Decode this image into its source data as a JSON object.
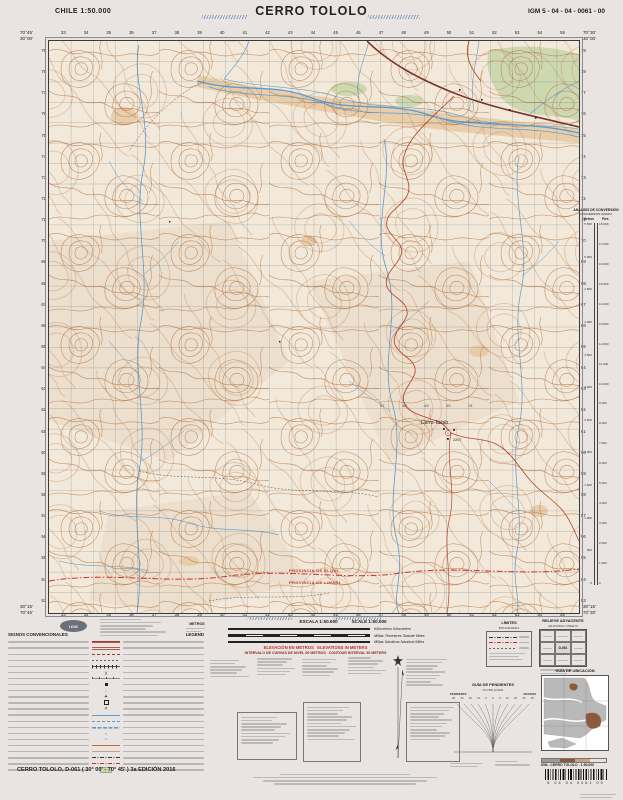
{
  "sheet": {
    "country_scale": "CHILE  1:50.000",
    "title": "CERRO TOLOLO",
    "code": "IGM 5 - 04 - 04 - 0061 - 00",
    "footer_line": "CERRO TOLOLO, D-061 ( 30° 00' - 70° 45' ) 3a EDICIÓN 2016",
    "igm_product_line": "IGM - CERRO TOLOLO - 1:50.000",
    "barcode_digits": "5  04  04  0061  00",
    "logo": "IGM"
  },
  "map": {
    "corners": {
      "top_left_lon": "70°45'",
      "top_right_lon": "70°30'",
      "top_lat": "30°00'",
      "bottom_lat": "30°15'",
      "bottom_left_lon": "70°45'",
      "bottom_right_lon": "70°30'"
    },
    "grid_eastings": [
      "33",
      "34",
      "35",
      "36",
      "37",
      "38",
      "39",
      "40",
      "41",
      "42",
      "43",
      "44",
      "45",
      "46",
      "47",
      "48",
      "49",
      "50",
      "51",
      "52",
      "53",
      "54",
      "55"
    ],
    "grid_northings": [
      "79",
      "78",
      "77",
      "76",
      "75",
      "74",
      "73",
      "72",
      "71",
      "70",
      "69",
      "68",
      "67",
      "66",
      "65",
      "64",
      "63",
      "62",
      "61",
      "60",
      "59",
      "58",
      "57",
      "56",
      "55",
      "54",
      "53"
    ],
    "interior_eastings": [
      "47",
      "48",
      "49",
      "50",
      "51"
    ],
    "labels": {
      "peak": "Cerro Tololo",
      "peak_elev": "2207",
      "prov_north": "PROVINCIA DE ELQUI",
      "prov_south": "PROVINCIA DE LIMARÍ"
    }
  },
  "conversion": {
    "title": "ANÁLISIS DE CONVERSIÓN",
    "subtitle": "CONVERSION GRAPH",
    "left": "Metros",
    "right": "Pies",
    "metros": [
      "5.500",
      "5.000",
      "4.500",
      "4.000",
      "3.500",
      "3.000",
      "2.500",
      "2.000",
      "1.500",
      "1.000",
      "500",
      "0"
    ],
    "pies": [
      "18.000",
      "17.000",
      "16.000",
      "15.000",
      "14.000",
      "13.000",
      "12.000",
      "11.000",
      "10.000",
      "9.000",
      "8.000",
      "7.000",
      "6.000",
      "5.000",
      "4.000",
      "3.000",
      "2.000",
      "1.000",
      "0"
    ]
  },
  "scalebars": {
    "escala": "ESCALA 1:50.000",
    "scale": "SCALE 1:50.000",
    "metros_note": "METROS",
    "rows": [
      {
        "es": "Kilómetros",
        "en": "Kilometers"
      },
      {
        "es": "Millas Terrestres",
        "en": "Statute Miles"
      },
      {
        "es": "Millas Náuticas",
        "en": "Nautical Miles"
      }
    ],
    "elev_es": "ELEVACIÓN EN METROS",
    "elev_en": "ELEVATIONS IN METERS",
    "interval_es": "INTERVALO DE CURVAS DE NIVEL 50 METROS",
    "interval_en": "CONTOUR INTERVAL 50 METERS"
  },
  "legend": {
    "title_es": "SIGNOS CONVENCIONALES",
    "title_en": "LEGEND",
    "symbols": [
      "road-paved",
      "road-gravel",
      "road-dirt",
      "trail",
      "railway",
      "bridge",
      "power-line",
      "building",
      "ruin",
      "church",
      "school",
      "mine",
      "stream",
      "stream-intermittent",
      "canal",
      "well",
      "spring",
      "contour-index",
      "contour",
      "boundary-intl",
      "boundary-prov",
      "vegetation"
    ]
  },
  "sections": {
    "limites": "LÍMITES",
    "limites_sub": "BOUNDARIES",
    "relieve": "RELIEVE ADYACENTE",
    "relieve_sub": "ADJOINING SHEETS",
    "relieve_center": "D-061",
    "pendientes": "GUÍA DE PENDIENTES",
    "pendientes_sub": "SLOPE GUIDE",
    "pend_left": "PENDIENTE",
    "pend_right": "GRADOS",
    "pend_values": [
      "45",
      "30",
      "20",
      "10",
      "5",
      "0",
      "5",
      "10",
      "20",
      "30",
      "45"
    ],
    "ubicacion": "GUÍA DE UBICACIÓN"
  },
  "colors": {
    "contour": "#b5713c",
    "water": "#5b9bd0",
    "road_major": "#7d352a",
    "road_minor": "#b7432e",
    "vegetation": "#c9d6ac",
    "wash": "#e6c9a2",
    "boundary": "#cc3333",
    "paper": "#f2e9da",
    "page_bg": "#e9e4e1"
  }
}
